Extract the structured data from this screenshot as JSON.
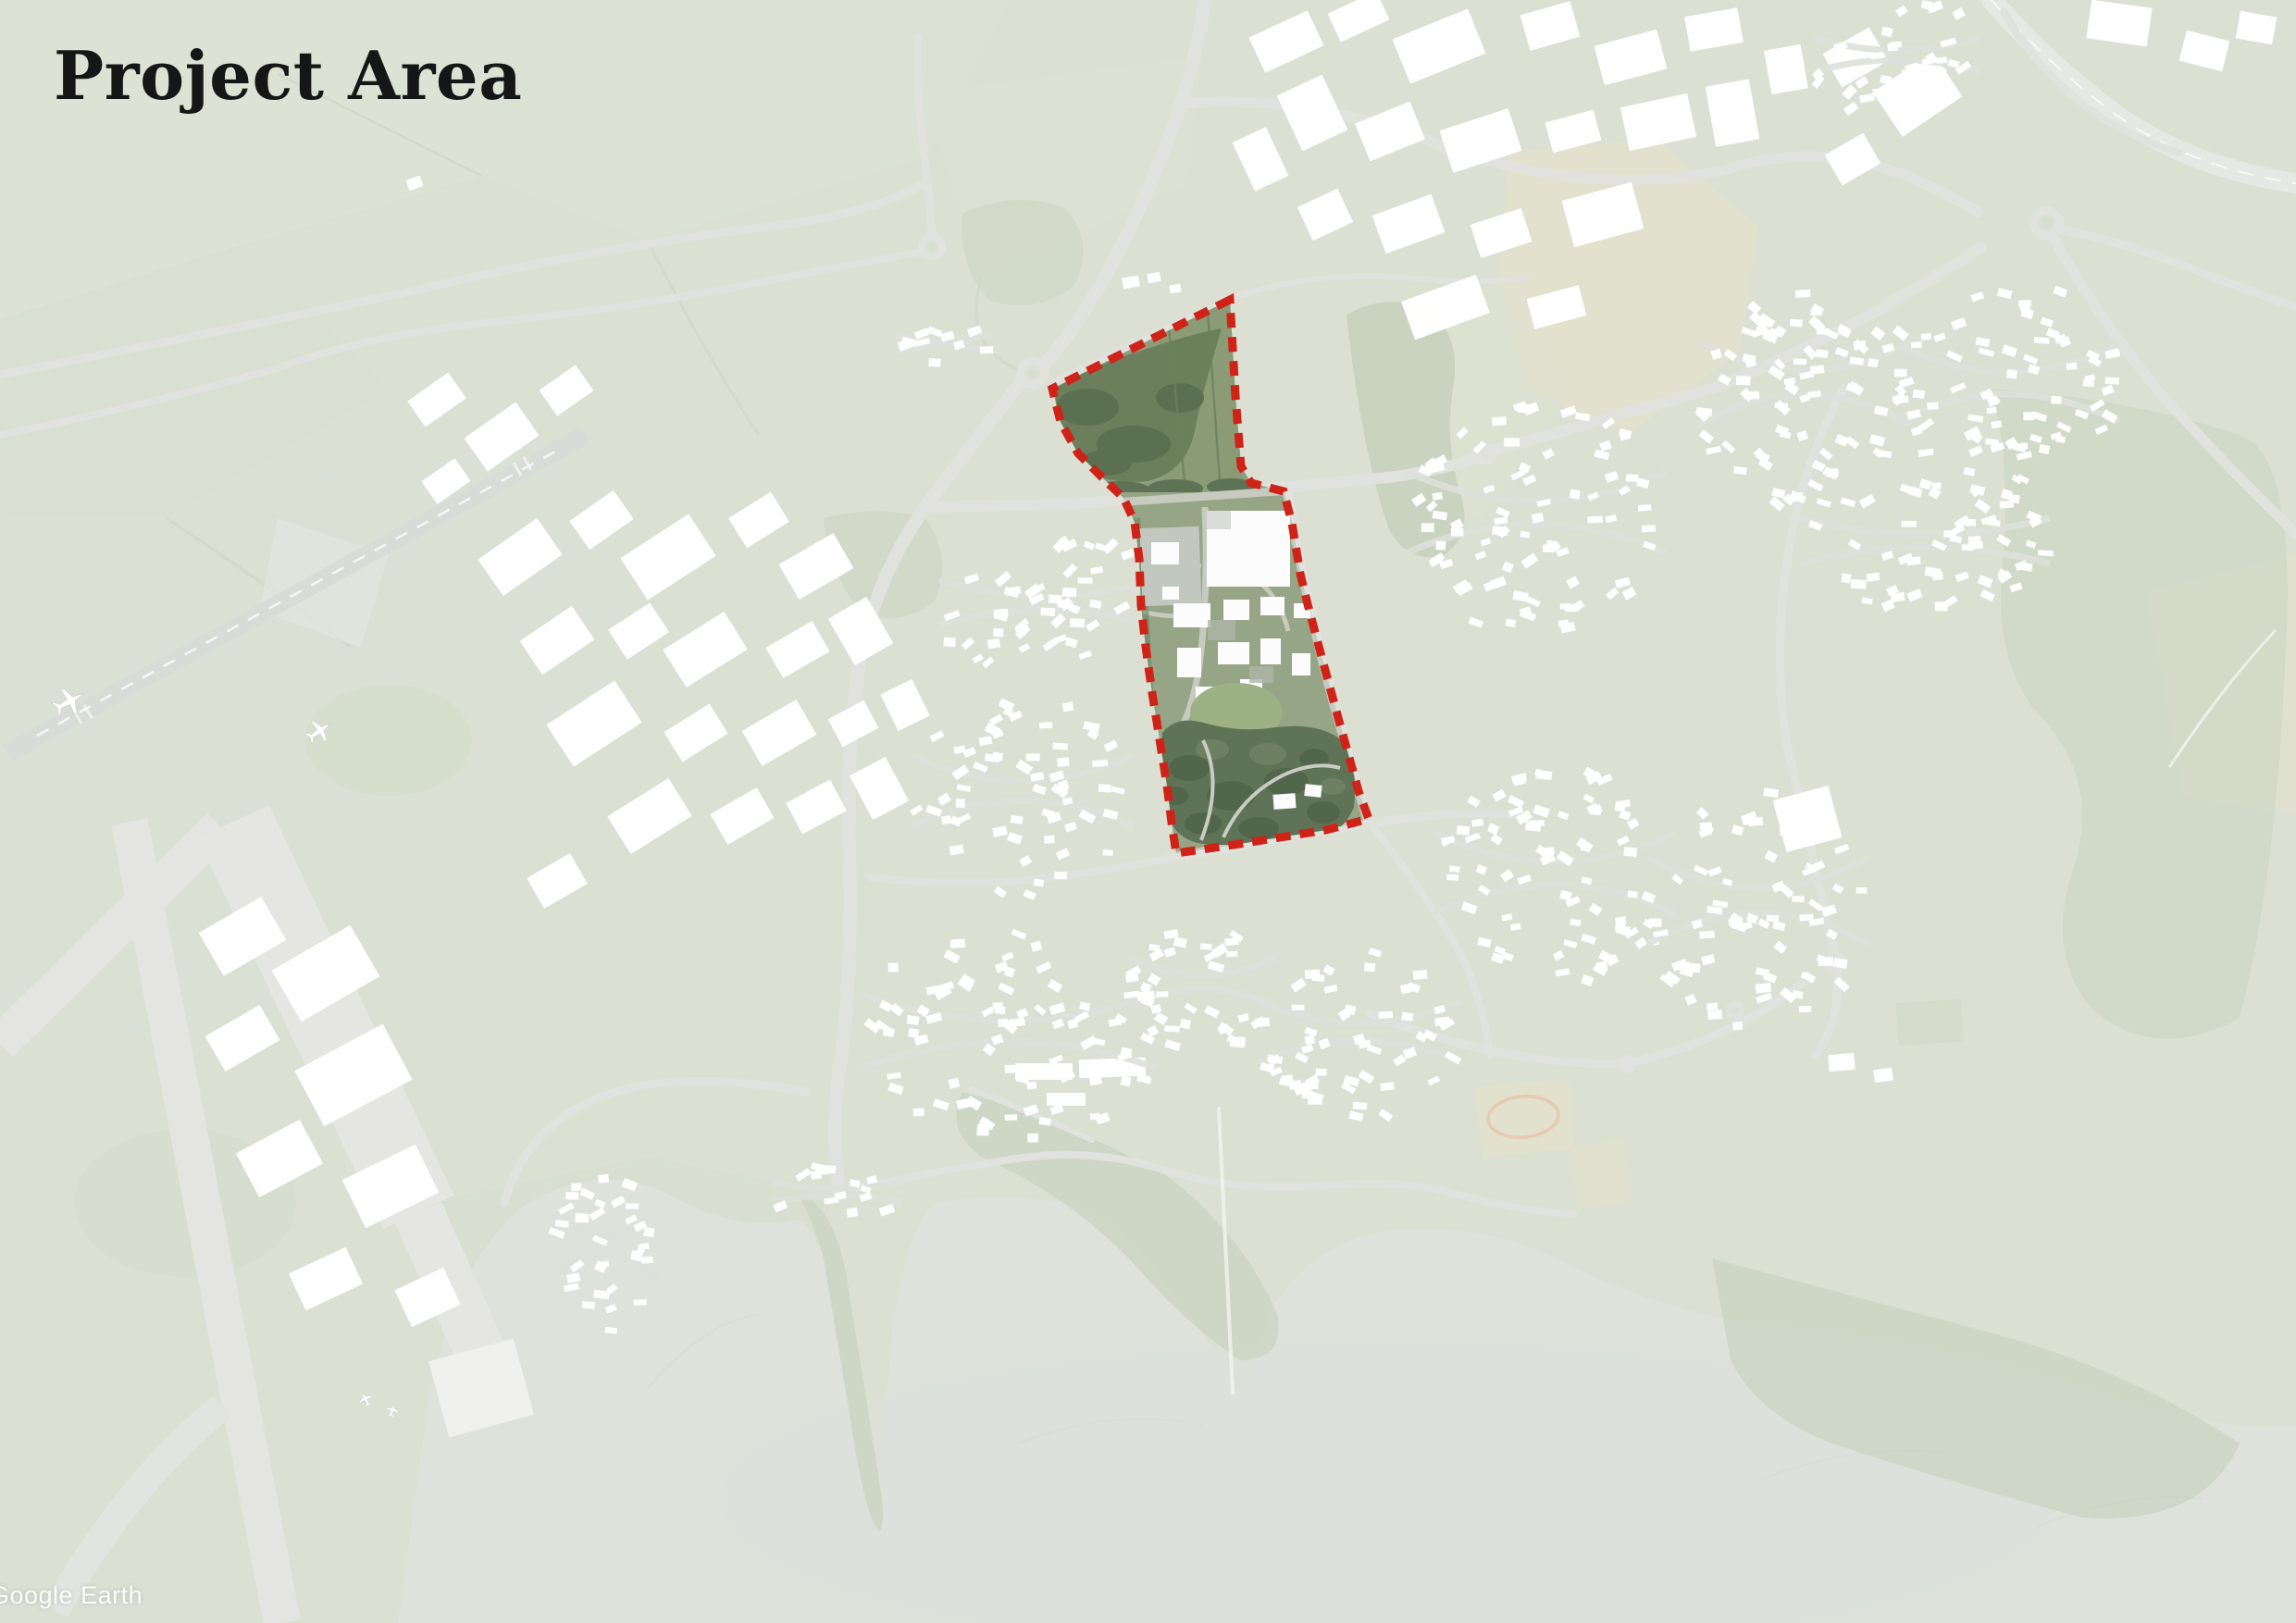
{
  "title": "Project Area",
  "attribution": "Google Earth",
  "map": {
    "kind": "aerial-basemap-with-highlighted-site",
    "colors": {
      "boundary_red": "#cf2318",
      "project_site_green": "#8d9d7f",
      "washed_basemap": "#dde1d4",
      "water_estuary": "#cdd3c8",
      "building_white": "#ffffff",
      "road_grey": "#d2d4cd"
    },
    "boundary_points": "1329,324 1137,420 1146,456 1165,490 1195,520 1214,538 1226,564 1231,604 1233,654 1238,699 1245,749 1253,799 1261,849 1266,889 1271,922 1333,913 1433,897 1479,885 1468,855 1448,783 1430,717 1413,653 1405,620 1396,565 1387,531 1352,522 1341,504 1335,428",
    "residential_clusters": [
      [
        1130,
        655,
        115,
        70,
        -12,
        45
      ],
      [
        1105,
        860,
        120,
        110,
        0,
        58
      ],
      [
        1090,
        1120,
        160,
        115,
        5,
        80
      ],
      [
        1300,
        1065,
        80,
        75,
        0,
        35
      ],
      [
        1470,
        1120,
        110,
        95,
        0,
        55
      ],
      [
        1660,
        560,
        140,
        125,
        -10,
        80
      ],
      [
        1680,
        950,
        130,
        125,
        0,
        75
      ],
      [
        1900,
        980,
        120,
        135,
        10,
        75
      ],
      [
        1950,
        420,
        115,
        130,
        15,
        80
      ],
      [
        2170,
        420,
        120,
        120,
        0,
        75
      ],
      [
        2080,
        588,
        135,
        70,
        0,
        52
      ],
      [
        655,
        1350,
        55,
        100,
        -8,
        32
      ],
      [
        905,
        1290,
        70,
        30,
        0,
        14
      ],
      [
        1020,
        372,
        52,
        26,
        0,
        10
      ],
      [
        2050,
        62,
        90,
        52,
        -20,
        28
      ]
    ],
    "industrial_buildings": [
      [
        1390,
        45,
        70,
        42,
        -25
      ],
      [
        1468,
        18,
        58,
        34,
        -25
      ],
      [
        1555,
        50,
        88,
        52,
        -22
      ],
      [
        1675,
        28,
        56,
        40,
        -16
      ],
      [
        1762,
        62,
        70,
        44,
        -15
      ],
      [
        1852,
        32,
        58,
        38,
        -10
      ],
      [
        1418,
        122,
        54,
        66,
        -25
      ],
      [
        1502,
        142,
        64,
        44,
        -22
      ],
      [
        1600,
        152,
        78,
        48,
        -18
      ],
      [
        1700,
        142,
        54,
        34,
        -15
      ],
      [
        1792,
        132,
        74,
        48,
        -12
      ],
      [
        1432,
        232,
        48,
        40,
        -25
      ],
      [
        1522,
        242,
        68,
        44,
        -20
      ],
      [
        1622,
        252,
        58,
        38,
        -18
      ],
      [
        1732,
        232,
        78,
        52,
        -15
      ],
      [
        1562,
        332,
        86,
        44,
        -20
      ],
      [
        1682,
        332,
        58,
        34,
        -15
      ],
      [
        1362,
        172,
        40,
        58,
        -25
      ],
      [
        1872,
        122,
        48,
        66,
        -10
      ],
      [
        1930,
        75,
        40,
        48,
        -10
      ],
      [
        2005,
        62,
        58,
        42,
        -30
      ],
      [
        2072,
        102,
        78,
        58,
        -34
      ],
      [
        2002,
        172,
        48,
        38,
        -30
      ],
      [
        2290,
        25,
        66,
        42,
        8
      ],
      [
        2382,
        55,
        48,
        34,
        14
      ],
      [
        2438,
        30,
        40,
        30,
        10
      ],
      [
        472,
        432,
        54,
        34,
        -35
      ],
      [
        542,
        472,
        68,
        44,
        -35
      ],
      [
        612,
        422,
        48,
        34,
        -35
      ],
      [
        482,
        520,
        44,
        30,
        -35
      ],
      [
        562,
        602,
        78,
        48,
        -35
      ],
      [
        650,
        562,
        58,
        38,
        -35
      ],
      [
        722,
        602,
        88,
        54,
        -33
      ],
      [
        820,
        562,
        54,
        38,
        -32
      ],
      [
        882,
        612,
        68,
        44,
        -30
      ],
      [
        602,
        692,
        68,
        44,
        -34
      ],
      [
        690,
        682,
        54,
        38,
        -33
      ],
      [
        762,
        702,
        78,
        48,
        -32
      ],
      [
        862,
        702,
        58,
        38,
        -30
      ],
      [
        930,
        682,
        48,
        58,
        -30
      ],
      [
        642,
        782,
        88,
        54,
        -33
      ],
      [
        752,
        792,
        58,
        38,
        -32
      ],
      [
        842,
        792,
        68,
        44,
        -30
      ],
      [
        922,
        782,
        44,
        34,
        -28
      ],
      [
        702,
        882,
        78,
        48,
        -32
      ],
      [
        802,
        882,
        58,
        38,
        -30
      ],
      [
        882,
        872,
        54,
        38,
        -28
      ],
      [
        950,
        852,
        44,
        54,
        -28
      ],
      [
        978,
        762,
        38,
        44,
        -26
      ],
      [
        602,
        952,
        54,
        38,
        -30
      ],
      [
        262,
        1012,
        78,
        54,
        -30
      ],
      [
        352,
        1052,
        98,
        64,
        -30
      ],
      [
        262,
        1122,
        68,
        44,
        -30
      ],
      [
        382,
        1162,
        108,
        68,
        -28
      ],
      [
        302,
        1252,
        78,
        54,
        -28
      ],
      [
        422,
        1282,
        88,
        58,
        -26
      ],
      [
        352,
        1382,
        68,
        44,
        -25
      ],
      [
        462,
        1402,
        58,
        44,
        -25
      ],
      [
        520,
        1500,
        95,
        85,
        -15,
        "#e8eae6"
      ],
      [
        1128,
        1158,
        62,
        18,
        0
      ],
      [
        1202,
        1154,
        72,
        20,
        -2
      ],
      [
        1152,
        1188,
        42,
        14,
        0
      ],
      [
        1953,
        885,
        62,
        58,
        -15
      ],
      [
        1990,
        1148,
        28,
        18,
        -5
      ],
      [
        2035,
        1162,
        20,
        14,
        -8
      ],
      [
        448,
        198,
        16,
        12,
        -20
      ],
      [
        1222,
        305,
        18,
        12,
        -10
      ],
      [
        1247,
        300,
        14,
        10,
        -10
      ],
      [
        1270,
        312,
        12,
        9,
        -10
      ]
    ]
  }
}
